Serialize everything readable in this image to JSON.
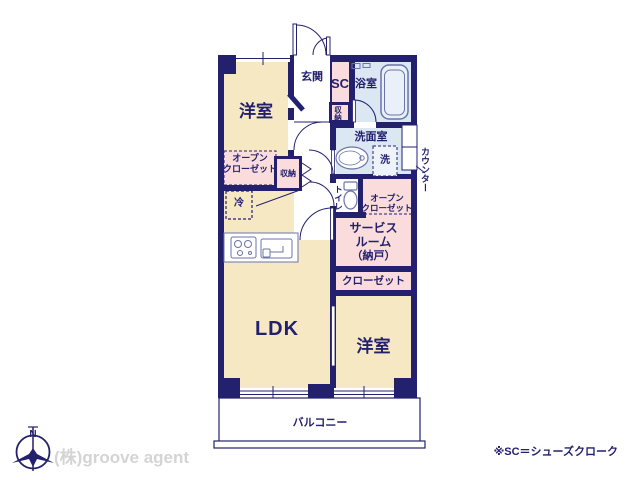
{
  "plan": {
    "rooms": {
      "bedroom_top": {
        "label": "洋室"
      },
      "bedroom_bottom": {
        "label": "洋室"
      },
      "ldk": {
        "label": "LDK"
      },
      "entrance": {
        "label": "玄関"
      },
      "shoes_closet": {
        "label": "SC"
      },
      "bathroom": {
        "label": "浴室"
      },
      "washroom": {
        "label": "洗面室"
      },
      "toilet": {
        "label": "トイレ"
      },
      "service_room": {
        "line1": "サービス",
        "line2": "ルーム",
        "line3": "（納戸）"
      },
      "closet": {
        "label": "クローゼット"
      },
      "open_closet_left": {
        "line1": "オープン",
        "line2": "クローゼット"
      },
      "open_closet_right": {
        "line1": "オープン",
        "line2": "クローゼット"
      },
      "storage_hall": {
        "label": "収納"
      },
      "storage_entry": {
        "label": "収納"
      },
      "balcony": {
        "label": "バルコニー"
      }
    },
    "fixtures": {
      "refrigerator": {
        "label": "冷"
      },
      "washing_machine": {
        "label": "洗"
      },
      "counter": {
        "label": "カウンター"
      }
    }
  },
  "annotations": {
    "compass_north": "N",
    "agency_logo": "(株)groove agent",
    "footnote": "※SC＝シューズクローク"
  },
  "colors": {
    "wall_navy": "#23206e",
    "room_cream": "#f7e8c4",
    "room_pink": "#f9dcdb",
    "room_blue": "#dbe7f2",
    "fixture_line": "#6b74a8",
    "logo_gray": "#d4d4d4"
  }
}
